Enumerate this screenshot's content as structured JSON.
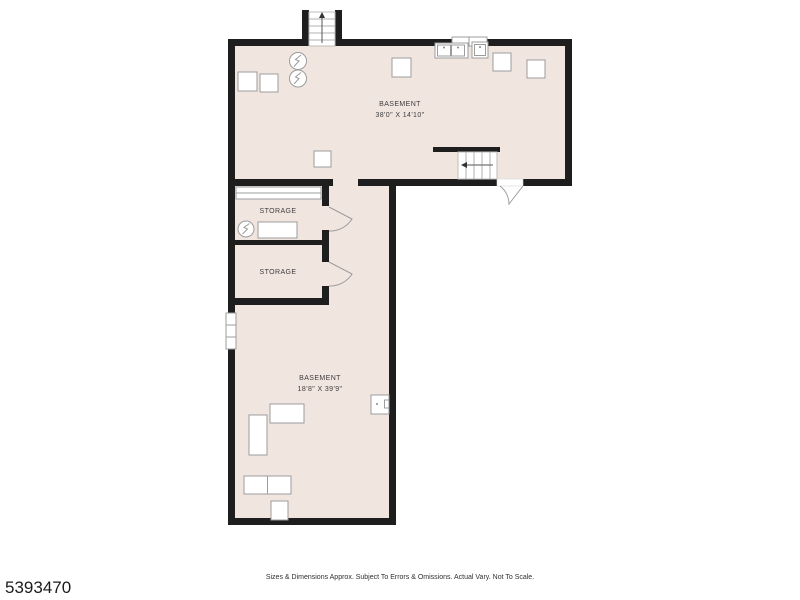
{
  "page": {
    "listing_id": "5393470",
    "disclaimer": "Sizes & Dimensions Approx. Subject To Errors & Omissions. Actual Vary. Not To Scale."
  },
  "rooms": {
    "basement_upper": {
      "label": "BASEMENT",
      "dimensions": "38'0\" X 14'10\""
    },
    "storage_top": {
      "label": "STORAGE"
    },
    "storage_bottom": {
      "label": "STORAGE"
    },
    "basement_lower": {
      "label": "BASEMENT",
      "dimensions": "18'8\" X 39'9\""
    }
  },
  "colors": {
    "room_fill": "#f1e5e0",
    "wall": "#1e1e1e",
    "fixture_stroke": "#9c9c9c",
    "label_text": "#3d3d3d",
    "id_text": "#1b1b1b"
  }
}
